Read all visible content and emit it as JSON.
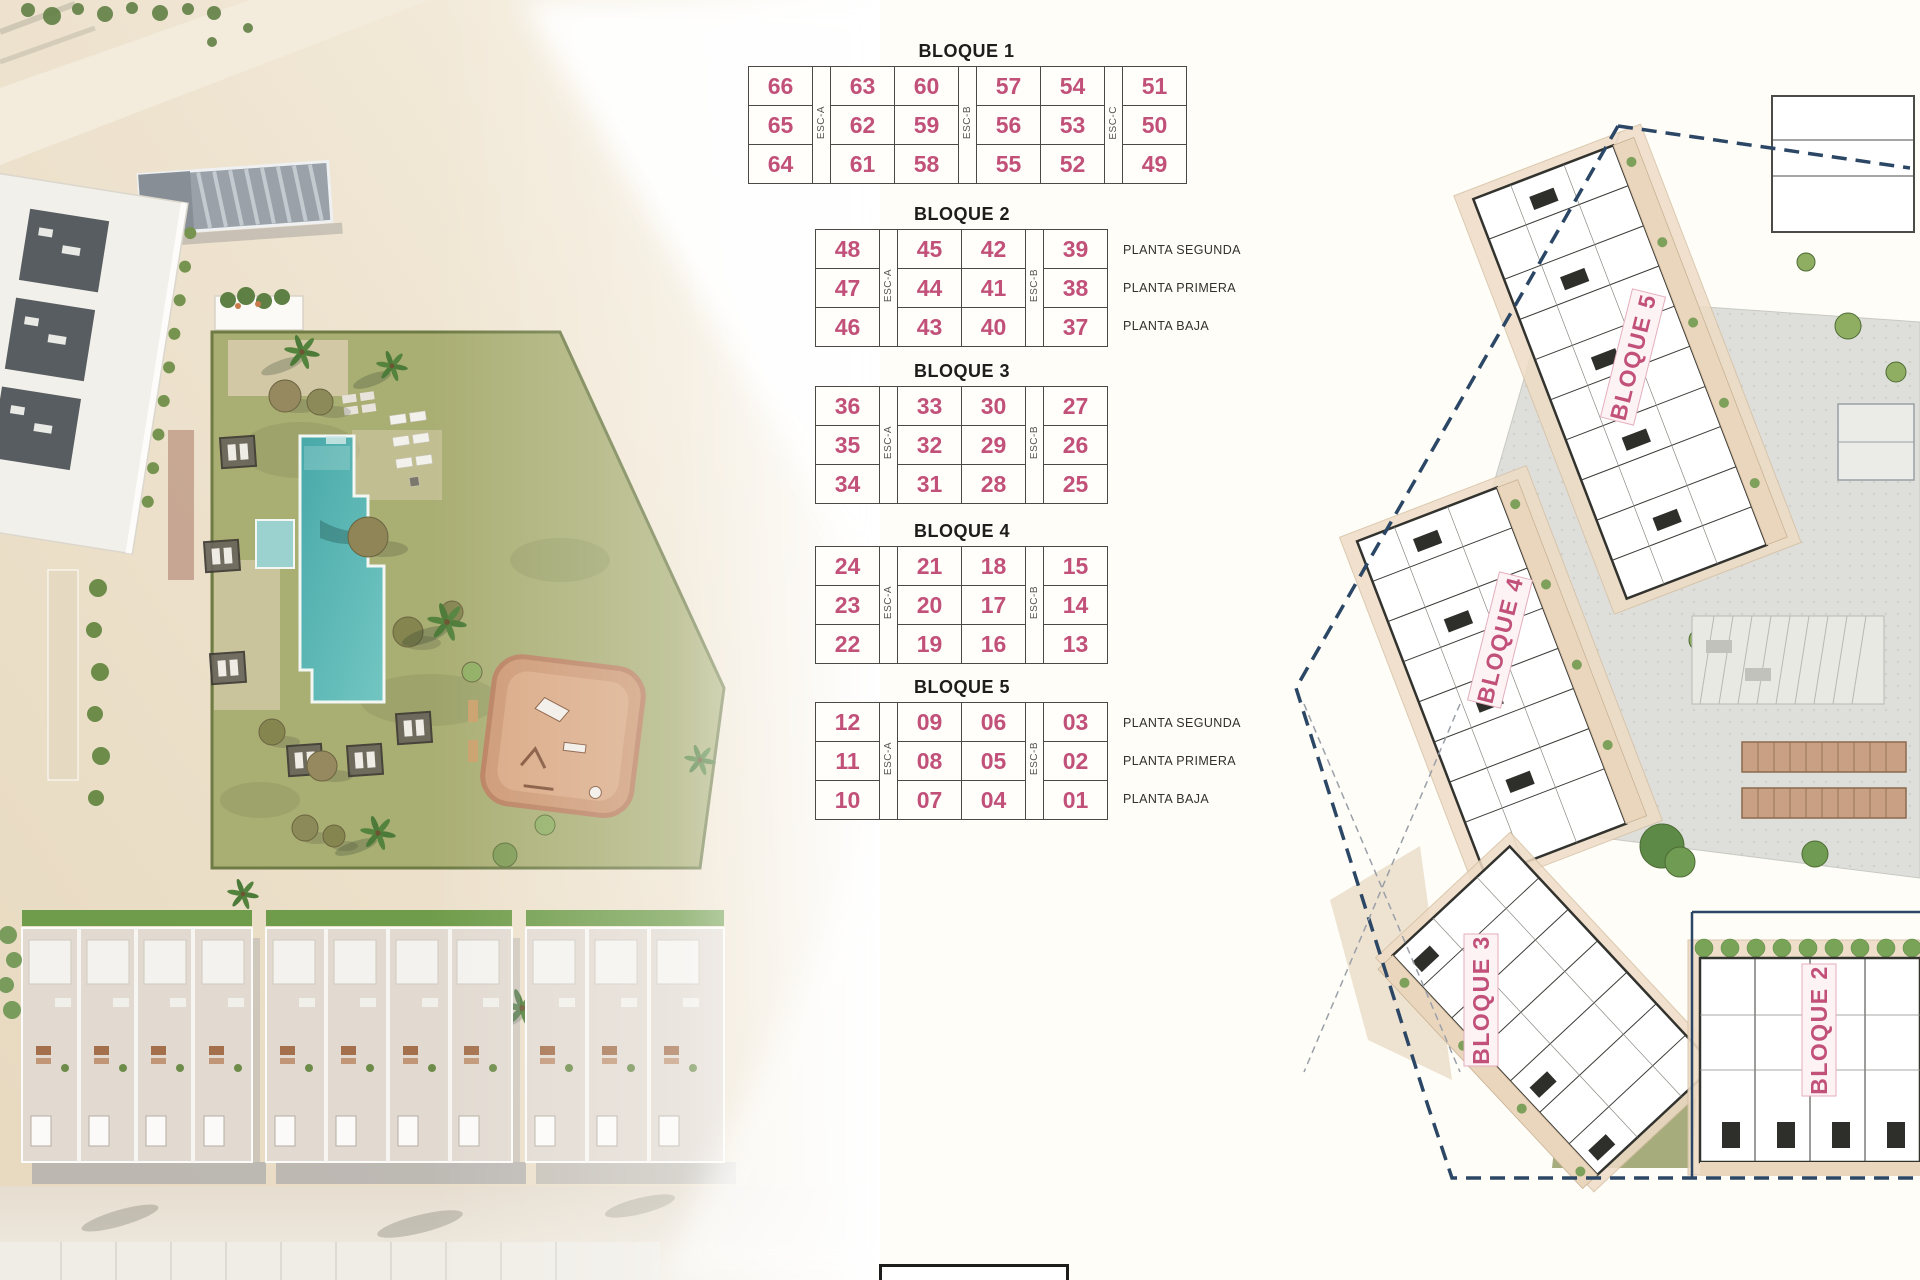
{
  "page": {
    "background": "#fefdf8"
  },
  "tables": {
    "blocks": [
      {
        "title": "BLOQUE 1",
        "stairwells": [
          "ESC-A",
          "ESC-B",
          "ESC-C"
        ],
        "rows": [
          [
            "66",
            "63",
            "60",
            "57",
            "54",
            "51"
          ],
          [
            "65",
            "62",
            "59",
            "56",
            "53",
            "50"
          ],
          [
            "64",
            "61",
            "58",
            "55",
            "52",
            "49"
          ]
        ],
        "floor_labels": []
      },
      {
        "title": "BLOQUE 2",
        "stairwells": [
          "ESC-A",
          "ESC-B"
        ],
        "rows": [
          [
            "48",
            "45",
            "42",
            "39"
          ],
          [
            "47",
            "44",
            "41",
            "38"
          ],
          [
            "46",
            "43",
            "40",
            "37"
          ]
        ],
        "floor_labels": [
          "PLANTA SEGUNDA",
          "PLANTA PRIMERA",
          "PLANTA BAJA"
        ]
      },
      {
        "title": "BLOQUE 3",
        "stairwells": [
          "ESC-A",
          "ESC-B"
        ],
        "rows": [
          [
            "36",
            "33",
            "30",
            "27"
          ],
          [
            "35",
            "32",
            "29",
            "26"
          ],
          [
            "34",
            "31",
            "28",
            "25"
          ]
        ],
        "floor_labels": []
      },
      {
        "title": "BLOQUE 4",
        "stairwells": [
          "ESC-A",
          "ESC-B"
        ],
        "rows": [
          [
            "24",
            "21",
            "18",
            "15"
          ],
          [
            "23",
            "20",
            "17",
            "14"
          ],
          [
            "22",
            "19",
            "16",
            "13"
          ]
        ],
        "floor_labels": []
      },
      {
        "title": "BLOQUE 5",
        "stairwells": [
          "ESC-A",
          "ESC-B"
        ],
        "rows": [
          [
            "12",
            "09",
            "06",
            "03"
          ],
          [
            "11",
            "08",
            "05",
            "02"
          ],
          [
            "10",
            "07",
            "04",
            "01"
          ]
        ],
        "floor_labels": [
          "PLANTA SEGUNDA",
          "PLANTA PRIMERA",
          "PLANTA BAJA"
        ]
      }
    ]
  },
  "site_plan": {
    "building_labels": [
      "BLOQUE 5",
      "BLOQUE 4",
      "BLOQUE 3",
      "BLOQUE 2"
    ]
  },
  "colors": {
    "unit_number": "#c2517a",
    "block_title": "#1d1d1b",
    "table_border": "#4b4944",
    "esc_text": "#56544d",
    "floor_label": "#33312c",
    "plan_label": "#c2517a",
    "plan_label_bg": "#fdf3f5",
    "boundary_dash": "#2b4765",
    "pool": "#55b5b4",
    "lawn": "#a9ae73",
    "terrace": "#eedcc6",
    "playground": "#cd9873",
    "plaza": "#dedfda"
  }
}
